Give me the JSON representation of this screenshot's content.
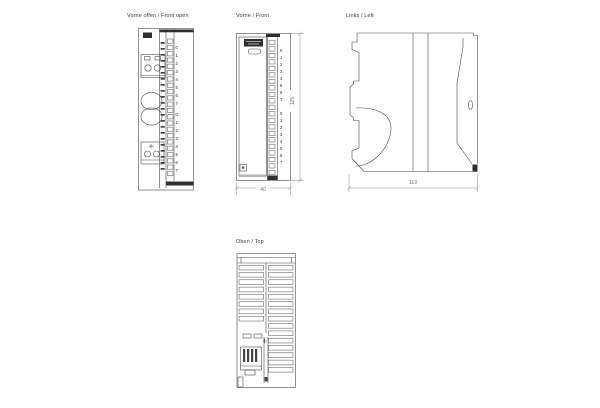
{
  "drawing": {
    "subject": "module-dimension-drawing",
    "colors": {
      "line": "#4a4a4a",
      "dark_fill": "#2f2f2f",
      "dim_line": "#7a7a7a",
      "title_text": "#3c3c3c"
    }
  },
  "views": {
    "front_open": {
      "title": "Vorne offen / Front open",
      "channels_top": [
        "0",
        "1",
        "2",
        "3",
        "4",
        "5",
        "6",
        "7"
      ],
      "channels_bottom": [
        "0",
        "1",
        "2",
        "3",
        "4",
        "5",
        "6",
        "7"
      ]
    },
    "front": {
      "title": "Vorne / Front",
      "channels_top": [
        "0",
        "1",
        "2",
        "3",
        "4",
        "5",
        "6",
        "7"
      ],
      "channels_bottom": [
        "0",
        "1",
        "2",
        "3",
        "4",
        "5",
        "6",
        "7"
      ],
      "dimensions": {
        "width_mm": "40",
        "height_mm": "125"
      }
    },
    "left": {
      "title": "Links / Left",
      "dimensions": {
        "depth_mm": "119"
      }
    },
    "top": {
      "title": "Oben / Top"
    }
  }
}
